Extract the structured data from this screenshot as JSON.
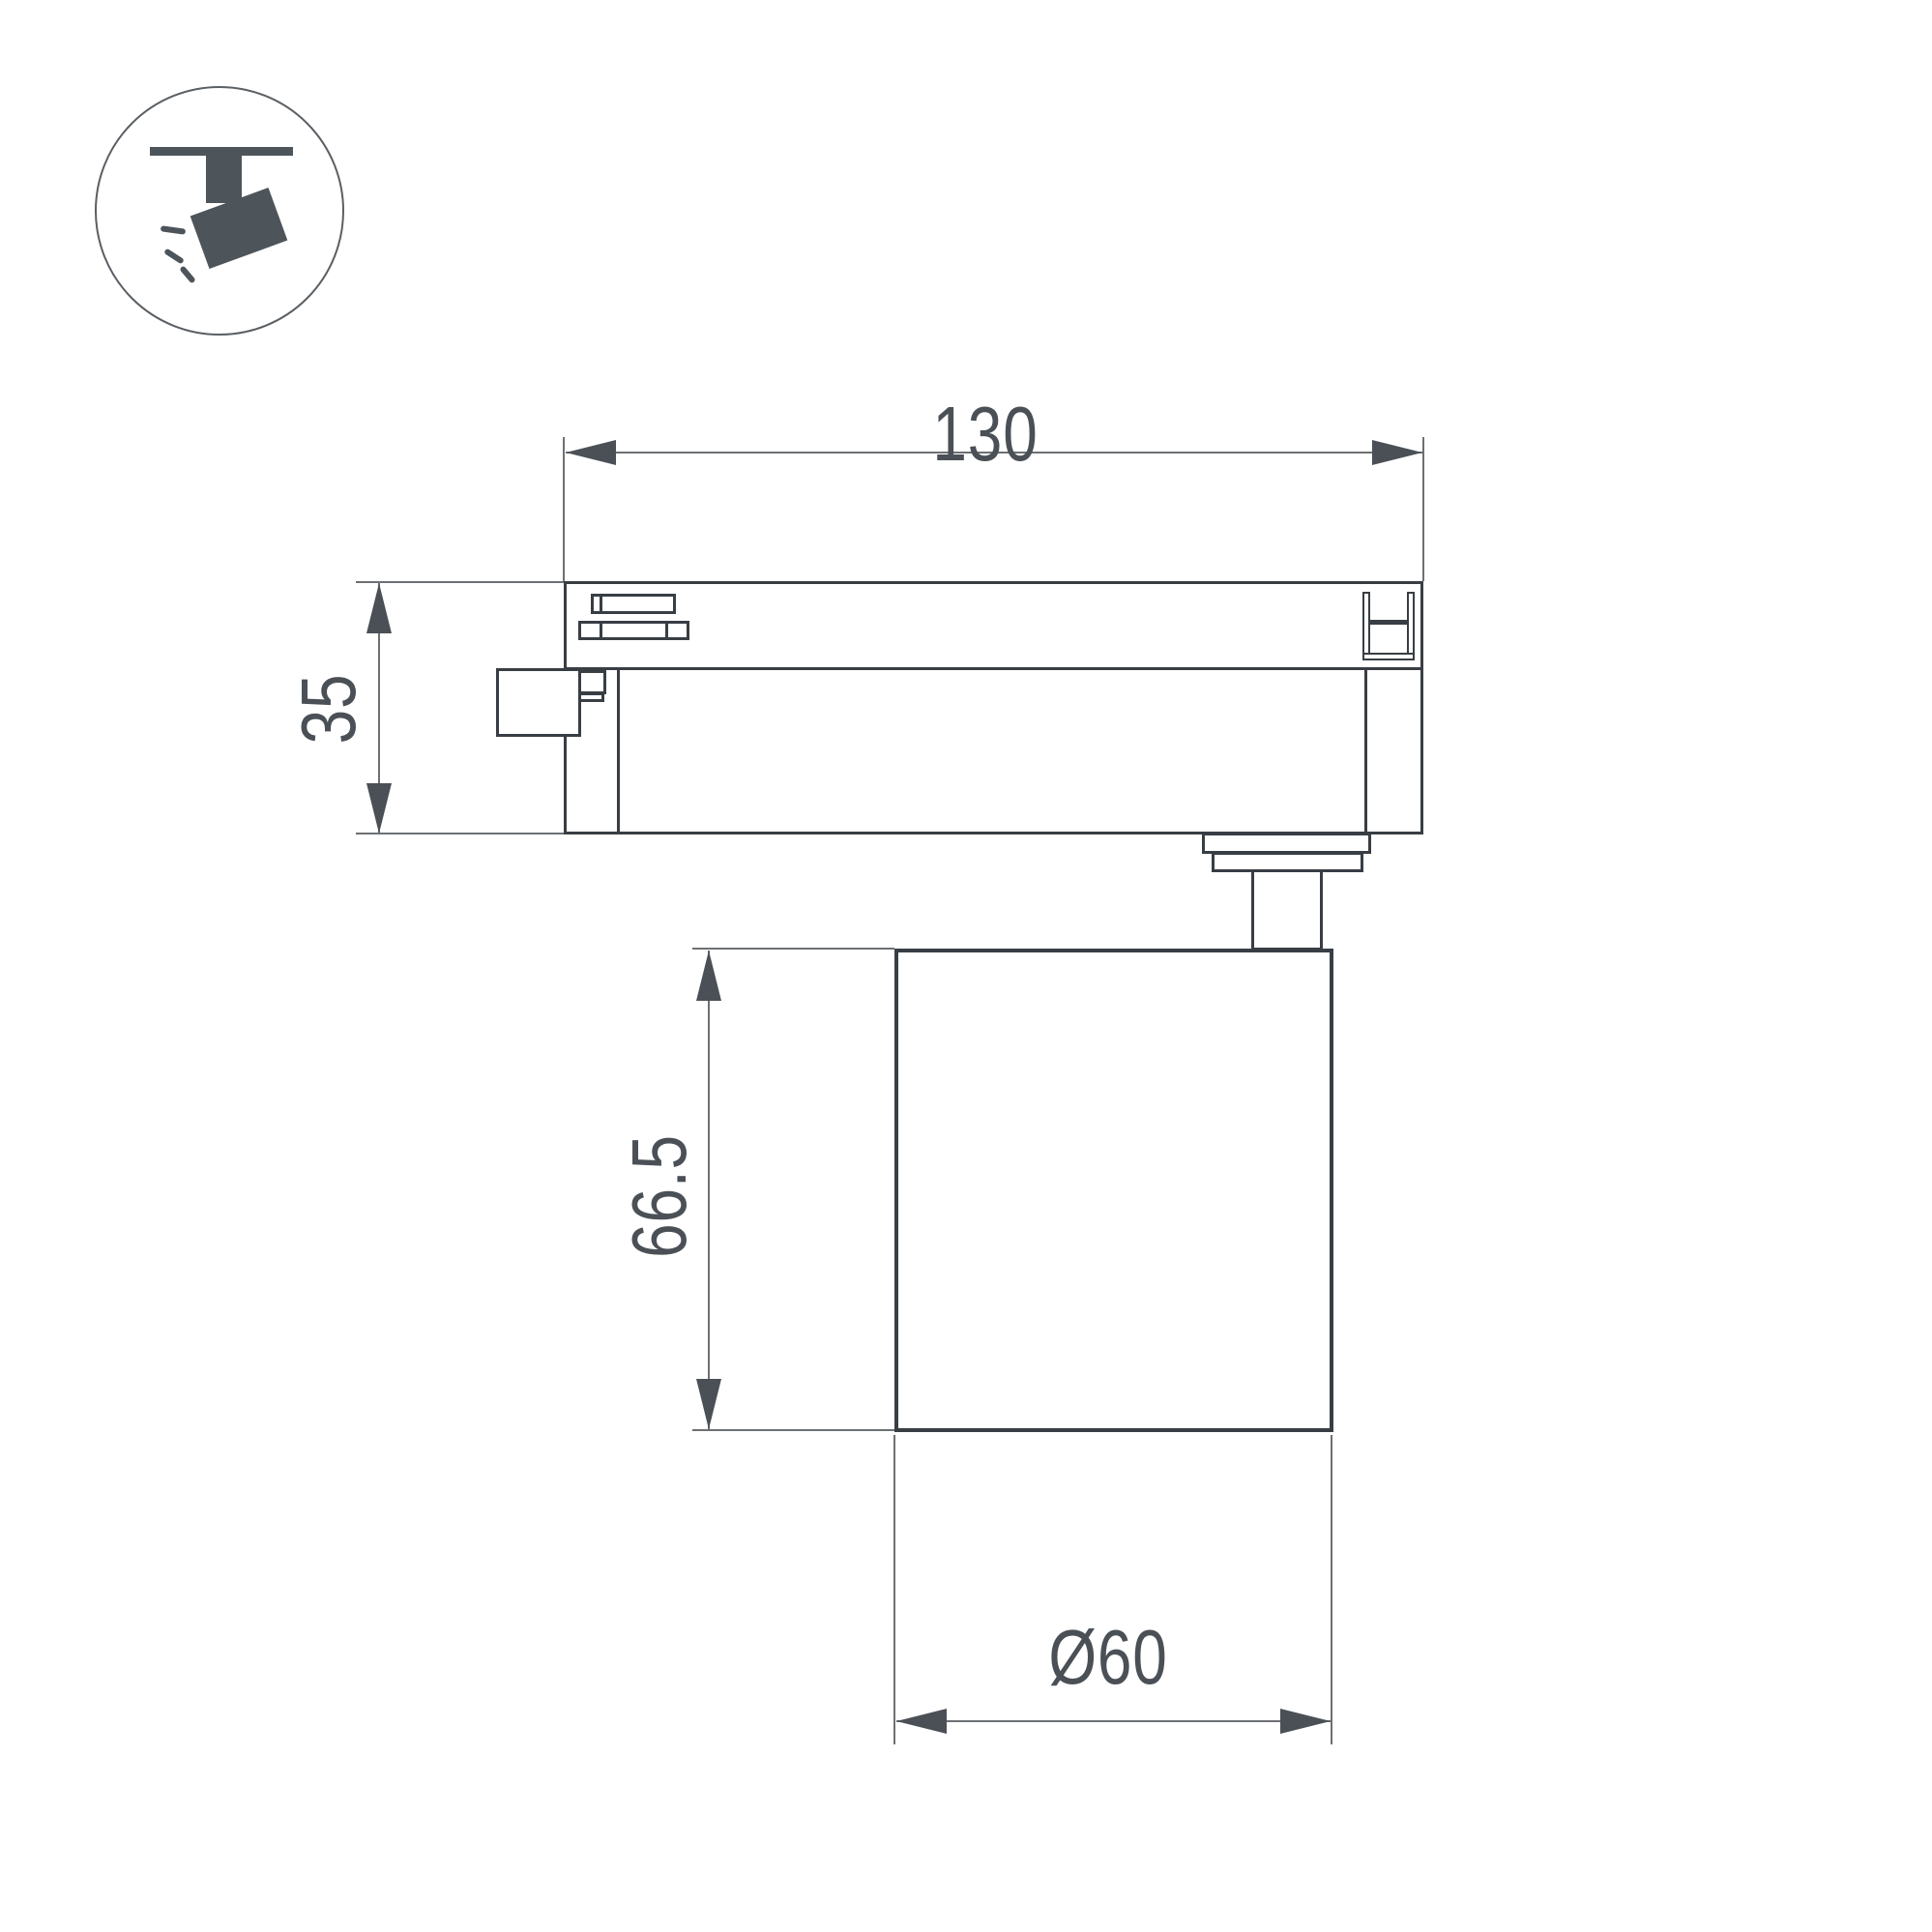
{
  "drawing": {
    "legend_icon": {
      "name": "track-spotlight-icon"
    },
    "dimensions": {
      "adapter_length": {
        "label": "130"
      },
      "adapter_height": {
        "label": "35"
      },
      "body_height": {
        "label": "66.5"
      },
      "body_diameter": {
        "label": "Ø60"
      }
    },
    "colors": {
      "outline": "#383e44",
      "thin_line": "#6d7074",
      "annotation": "#4a5056",
      "icon": "#4d545a",
      "background": "#ffffff"
    }
  }
}
